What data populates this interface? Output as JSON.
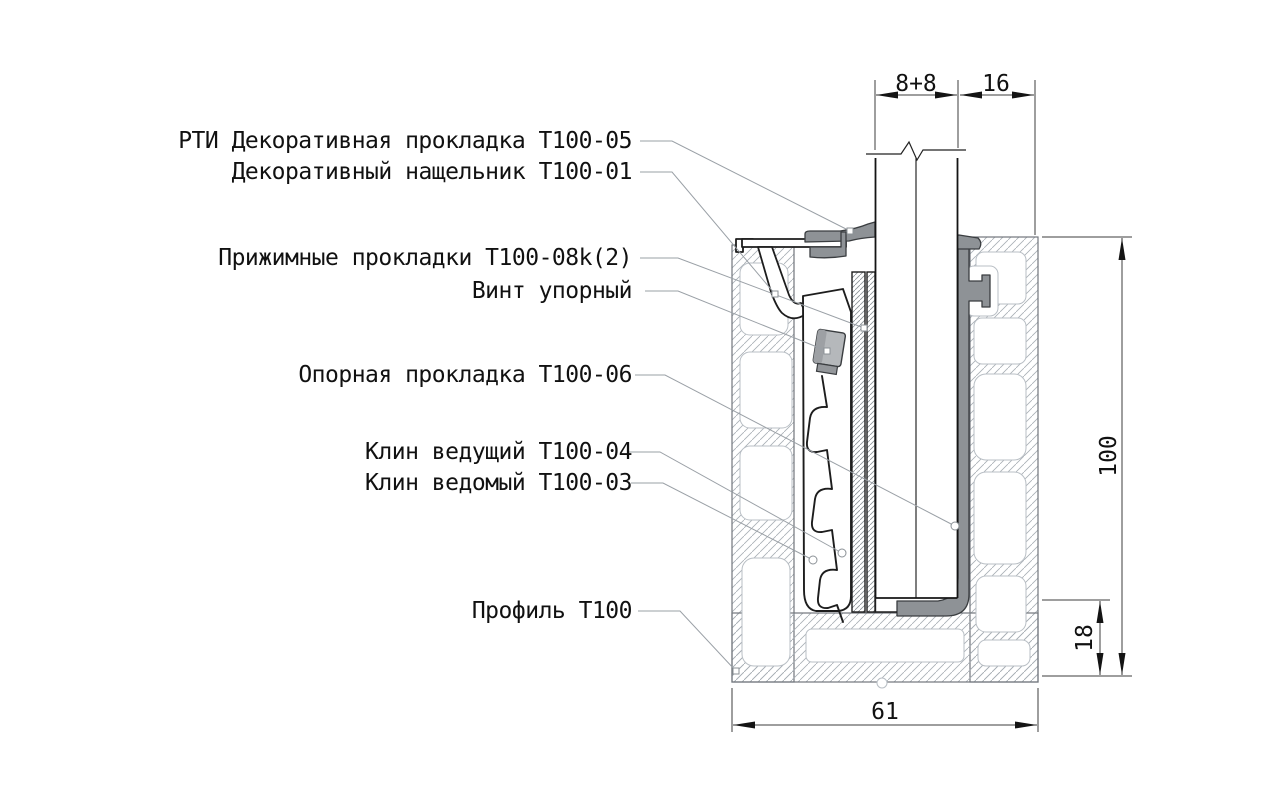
{
  "drawing": {
    "title": "Профиль Т100 — узел крепления стекла (сечение)",
    "labels": [
      {
        "id": "decorative-gasket",
        "text": "РТИ Декоративная прокладка Т100-05"
      },
      {
        "id": "decorative-cover",
        "text": "Декоративный нащельник Т100-01"
      },
      {
        "id": "pressure-gaskets",
        "text": "Прижимные прокладки Т100-08k(2)"
      },
      {
        "id": "stop-screw",
        "text": "Винт упорный"
      },
      {
        "id": "support-gasket",
        "text": "Опорная прокладка Т100-06"
      },
      {
        "id": "driving-wedge",
        "text": "Клин ведущий Т100-04"
      },
      {
        "id": "driven-wedge",
        "text": "Клин ведомый Т100-03"
      },
      {
        "id": "profile",
        "text": "Профиль Т100"
      }
    ],
    "dimensions": {
      "glass_pack": "8+8",
      "rebate": "16",
      "height": "100",
      "bottom_shelf": "18",
      "width": "61"
    },
    "colors": {
      "gasket_gray": "#8e9296",
      "outline_black": "#1d1d1d",
      "leader_gray": "#9aa0a6",
      "hatch_gray": "#a9afb5"
    }
  }
}
